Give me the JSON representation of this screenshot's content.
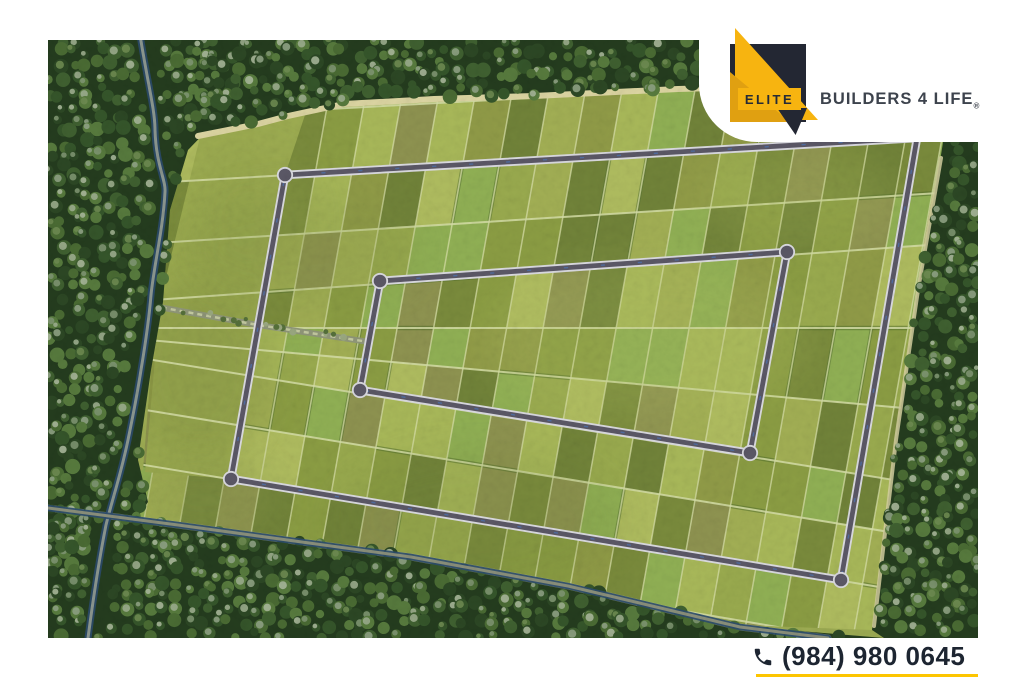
{
  "brand": {
    "name": "ELITE",
    "tagline": "BUILDERS 4 LIFE",
    "registered_mark": "®"
  },
  "contact": {
    "phone": "(984) 980 0645"
  },
  "icons": {
    "logo_mark": "elite-triangle-logo",
    "phone": "phone-icon"
  },
  "colors": {
    "brand_yellow": "#f7b410",
    "brand_amber": "#e0a011",
    "brand_navy": "#232733",
    "tagline_gray": "#3d434d",
    "phone_text": "#1d2531",
    "underline_yellow": "#fdc500",
    "road_gray": "#5b5866",
    "road_casing": "#dadae0",
    "water_blue": "#2b4a6b",
    "field_green": "#9cab52",
    "forest_green": "#243c1e"
  },
  "map": {
    "kind": "aerial-subdivision-site-plan"
  }
}
